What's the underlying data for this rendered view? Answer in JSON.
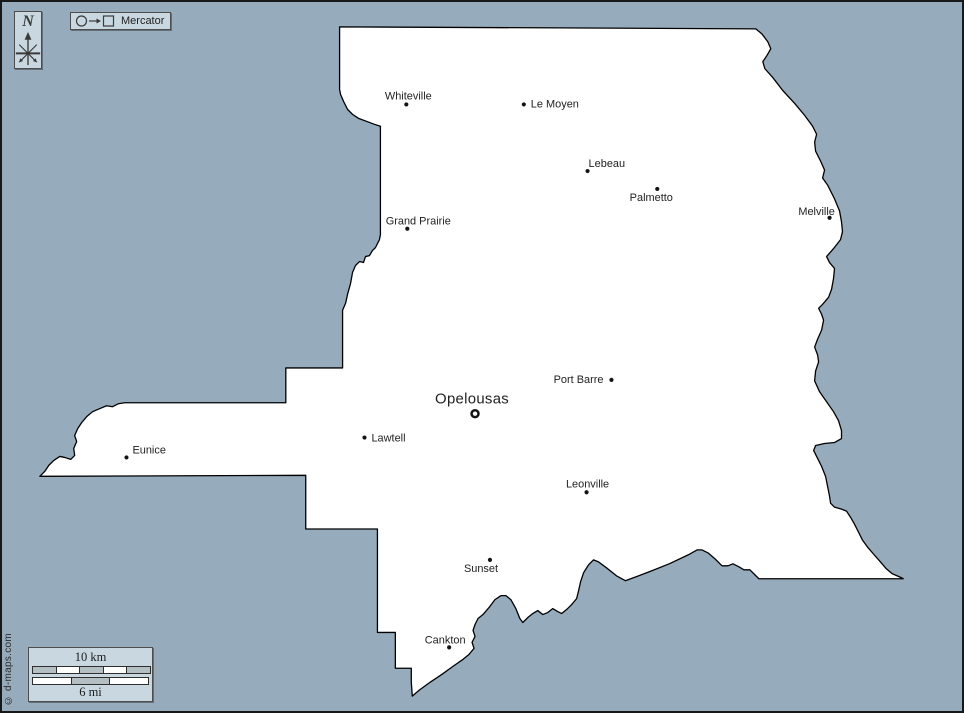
{
  "colors": {
    "background": "#96abbc",
    "panel_fill": "#c9d8e0",
    "panel_border": "#4d4d4d",
    "map_fill": "#ffffff",
    "map_stroke": "#000000",
    "text": "#222222",
    "scale_gray": "#b3bfc3"
  },
  "compass": {
    "north_label": "N"
  },
  "projection": {
    "label": "Mercator"
  },
  "scale_bar": {
    "km_label": "10 km",
    "mi_label": "6 mi",
    "km_pattern": [
      "gray",
      "white",
      "gray",
      "white",
      "gray"
    ],
    "mi_pattern": [
      "white",
      "gray",
      "white"
    ]
  },
  "credit": "© d-maps.com",
  "map": {
    "outline_points": "339,25 757,27 763,32 769,40 772,47 768,54 764,60 766,67 774,76 784,89 796,102 806,114 814,125 818,133 816,141 817,150 822,160 826,169 824,177 829,184 836,198 841,210 843,221 844,231 842,239 835,248 828,256 831,262 836,268 835,278 833,289 830,297 824,304 820,308 823,314 825,320 823,330 819,339 816,347 819,355 820,362 817,371 816,381 821,392 828,402 835,412 840,421 843,431 843,439 836,443 826,444 817,446 815,451 819,459 823,467 827,477 829,487 831,497 832,504 836,508 843,510 848,512 852,518 856,525 860,533 864,541 869,548 875,555 882,563 888,570 894,575 901,578 905,580 760,580 756,576 751,571 745,571 740,568 734,565 729,567 723,567 716,560 709,554 703,551 698,551 689,556 670,565 650,573 634,579 626,582 617,577 607,569 599,563 594,561 589,566 584,574 581,583 579,592 577,600 572,606 568,610 562,615 558,613 553,610 548,614 543,616 538,612 533,615 528,619 523,624 520,620 516,610 511,601 506,597 501,597 495,601 489,609 483,616 478,620 475,626 473,632 475,638 472,644 474,650 469,656 463,661 453,668 442,676 430,684 419,692 412,698 411,684 411,670 395,670 395,634 377,634 377,530 305,530 305,476 38,477 43,472 47,466 52,461 58,457 63,458 69,460 73,456 72,449 75,442 73,436 76,429 80,423 85,417 91,412 98,409 105,406 111,407 117,404 123,403 285,403 285,368 342,368 342,310 345,303 347,294 350,283 352,272 355,265 359,261 363,262 365,256 369,255 372,250 375,247 379,239 380,234 380,125 374,123 366,120 358,117 352,113 347,108 343,100 340,93 339,88",
    "cities": [
      {
        "name": "Whiteville",
        "dot": [
          406,
          103
        ],
        "label": [
          408,
          98
        ],
        "anchor": "middle"
      },
      {
        "name": "Le Moyen",
        "dot": [
          524,
          103
        ],
        "label": [
          531,
          106
        ],
        "anchor": "start"
      },
      {
        "name": "Lebeau",
        "dot": [
          588,
          170
        ],
        "label": [
          589,
          166
        ],
        "anchor": "start"
      },
      {
        "name": "Palmetto",
        "dot": [
          658,
          188
        ],
        "label": [
          652,
          200
        ],
        "anchor": "middle"
      },
      {
        "name": "Melville",
        "dot": [
          831,
          217
        ],
        "label": [
          818,
          214
        ],
        "anchor": "middle"
      },
      {
        "name": "Grand Prairie",
        "dot": [
          407,
          228
        ],
        "label": [
          418,
          224
        ],
        "anchor": "middle"
      },
      {
        "name": "Port Barre",
        "dot": [
          612,
          380
        ],
        "label": [
          604,
          383
        ],
        "anchor": "end"
      },
      {
        "name": "Opelousas",
        "dot": [
          475,
          414
        ],
        "label": [
          472,
          404
        ],
        "anchor": "middle",
        "marker": "ring",
        "major": true
      },
      {
        "name": "Lawtell",
        "dot": [
          364,
          438
        ],
        "label": [
          371,
          442
        ],
        "anchor": "start"
      },
      {
        "name": "Eunice",
        "dot": [
          125,
          458
        ],
        "label": [
          131,
          454
        ],
        "anchor": "start"
      },
      {
        "name": "Leonville",
        "dot": [
          587,
          493
        ],
        "label": [
          588,
          488
        ],
        "anchor": "middle"
      },
      {
        "name": "Sunset",
        "dot": [
          490,
          561
        ],
        "label": [
          481,
          573
        ],
        "anchor": "middle"
      },
      {
        "name": "Cankton",
        "dot": [
          449,
          649
        ],
        "label": [
          445,
          645
        ],
        "anchor": "middle"
      }
    ]
  }
}
